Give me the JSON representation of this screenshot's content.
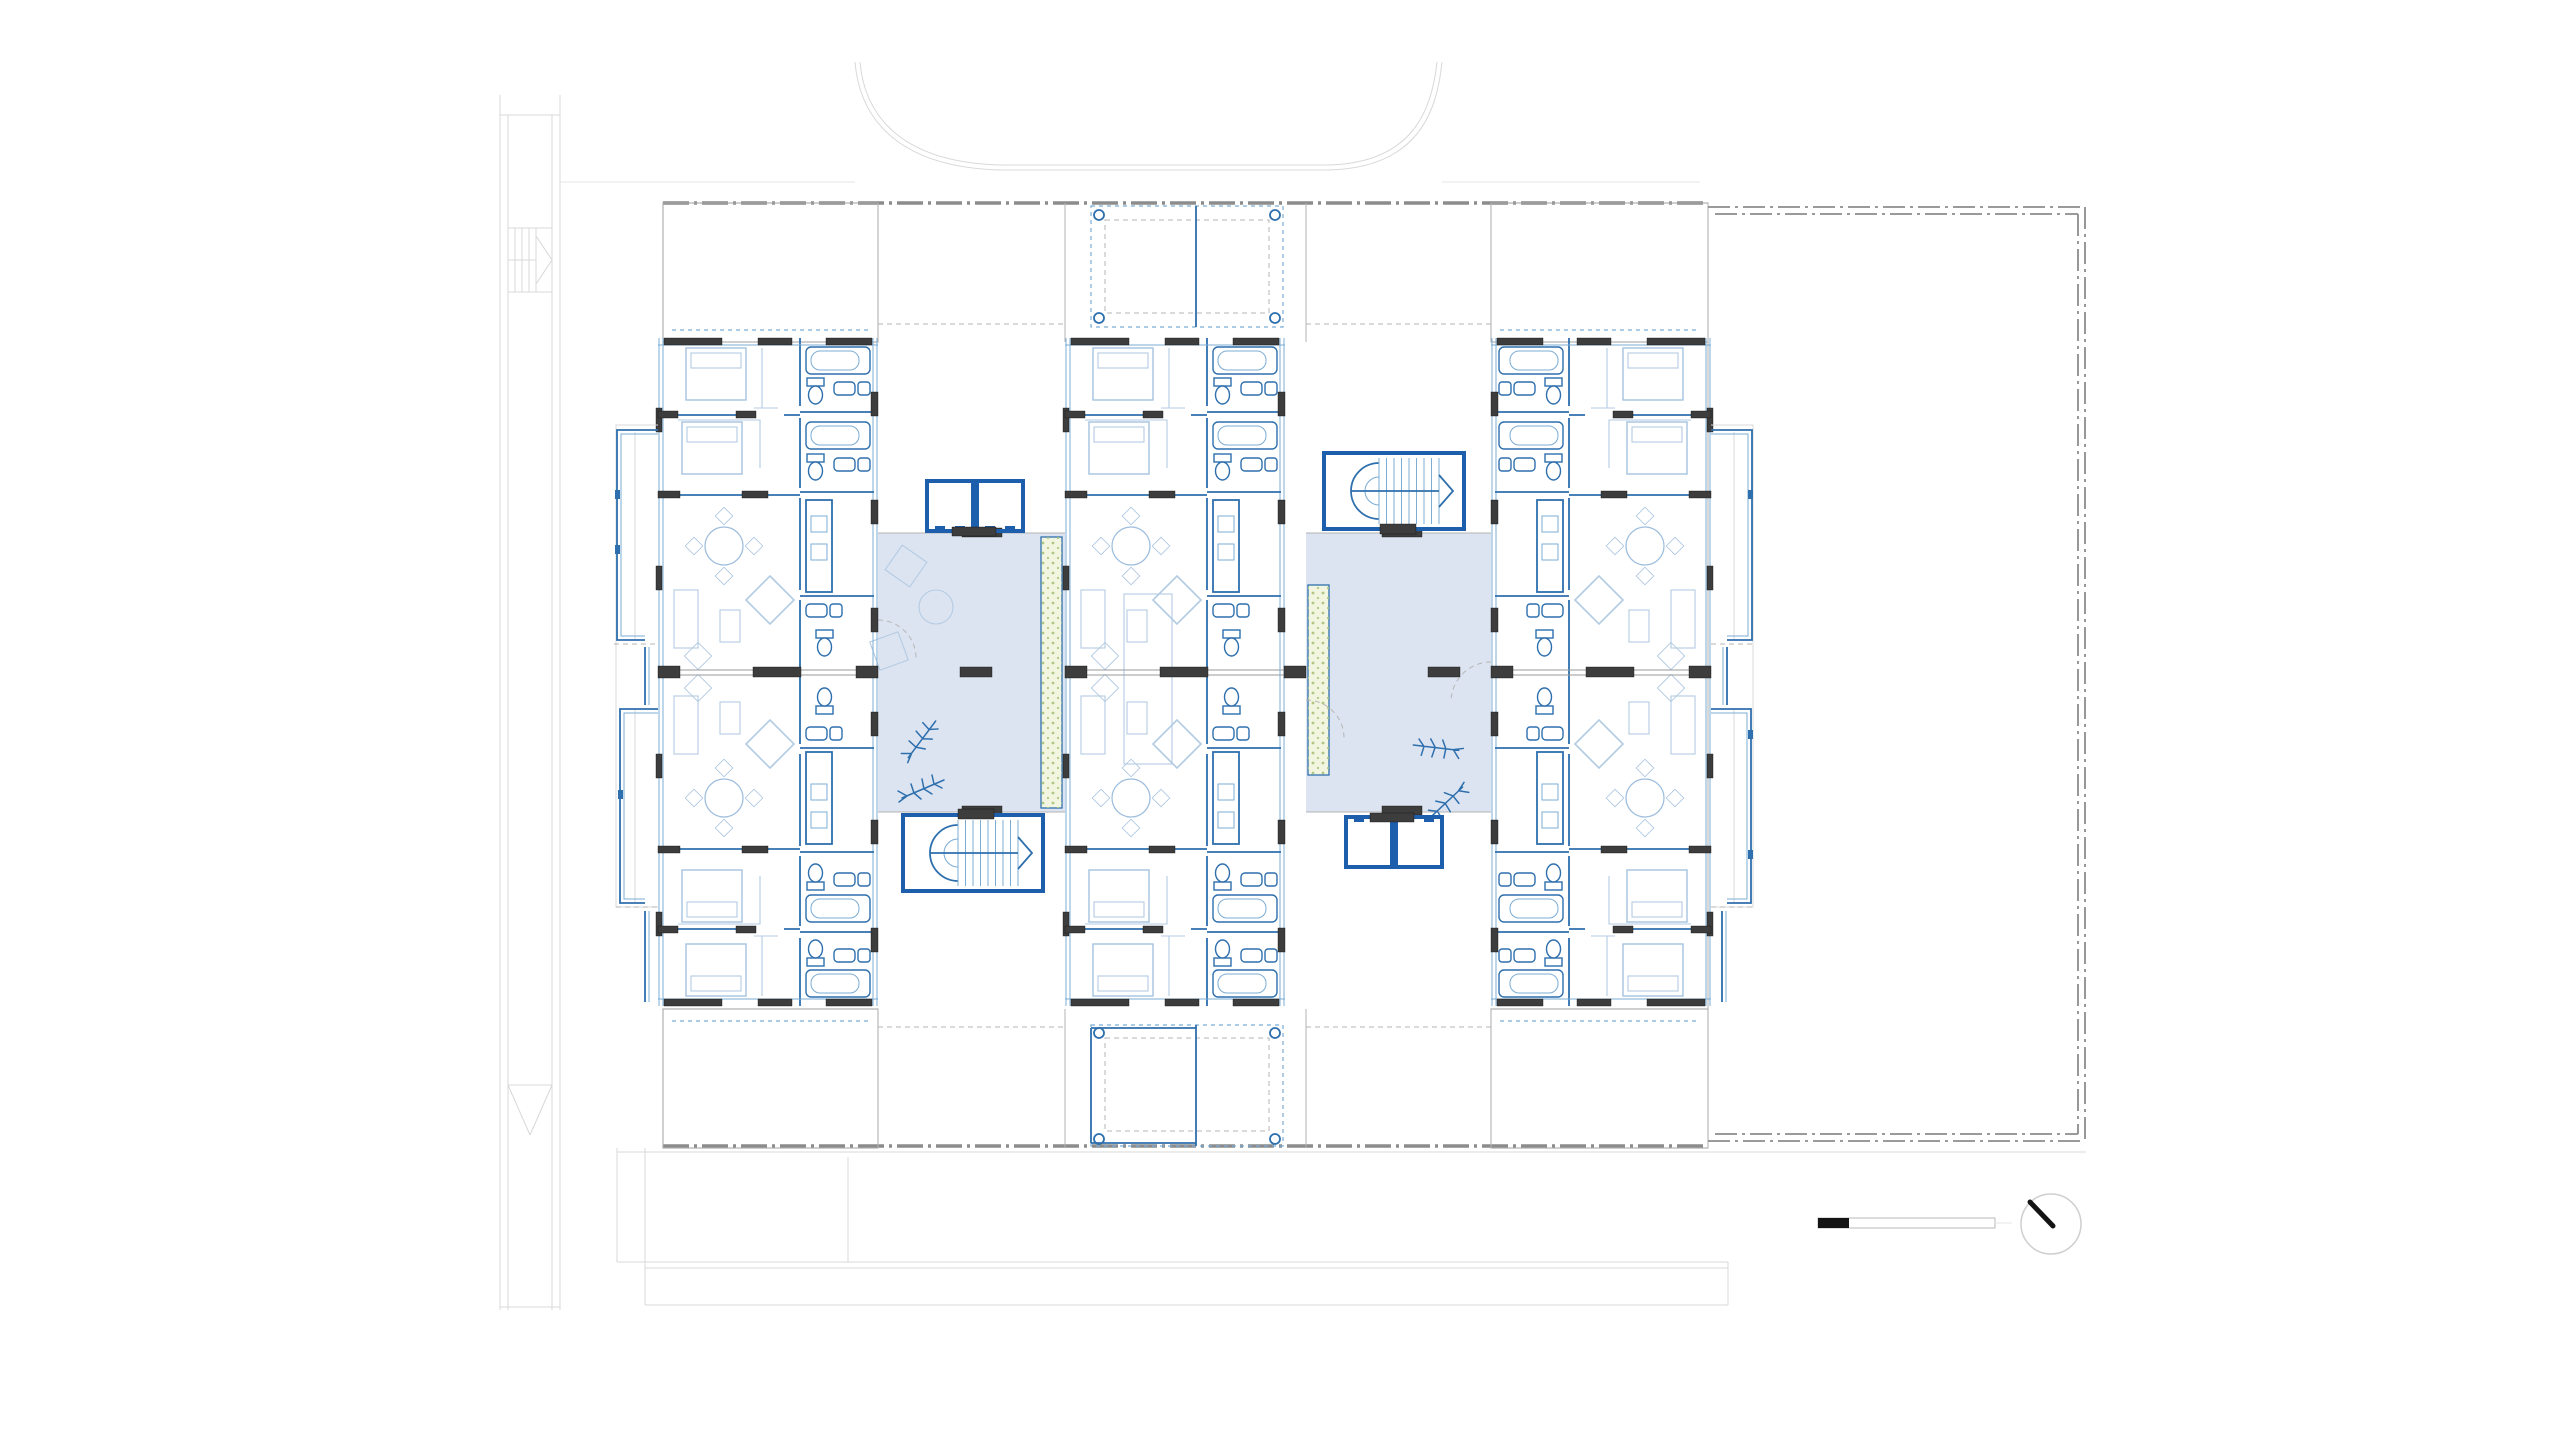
{
  "colors": {
    "paper": "#ffffff",
    "wall_blue": "#2e6fad",
    "deep_blue": "#1d5fad",
    "glazing_blue": "#7bacd4",
    "furniture_blue": "#9fbedd",
    "light_blue": "#b3cbe3",
    "wall_dark": "#3d3d3d",
    "outline_gray": "#8c8c8c",
    "context_gray": "#d8d8d8",
    "courtyard_fill": "#dde4f1",
    "planting_fill": "#f2f5e0",
    "planting_dot": "#aec781",
    "scale_black": "#141414"
  },
  "plan": {
    "type": "residential-floor-plan",
    "wings": [
      {
        "id": "west-wing",
        "apartments": 2,
        "features": [
          "bedrooms",
          "dining-table",
          "bathrooms",
          "kitchen",
          "stepped-balconies-west"
        ]
      },
      {
        "id": "center-wing",
        "apartments": 2,
        "features": [
          "bedrooms",
          "dining-table",
          "bathrooms",
          "kitchen",
          "north-balcony",
          "south-balcony"
        ]
      },
      {
        "id": "east-wing",
        "apartments": 2,
        "features": [
          "bedrooms",
          "dining-table",
          "bathrooms",
          "kitchen",
          "stepped-balconies-east"
        ]
      }
    ],
    "courtyards": [
      {
        "id": "west-courtyard",
        "features": [
          "elevator-pair-north",
          "open-stair-south",
          "planting-strip-east",
          "loose-furniture",
          "plant-symbols"
        ]
      },
      {
        "id": "east-courtyard",
        "features": [
          "open-stair-north",
          "elevator-pair-south",
          "planting-strip-west",
          "plant-symbols"
        ]
      }
    ],
    "balconies": [
      "north-balcony",
      "south-balcony"
    ],
    "terrace": {
      "id": "east-terrace",
      "border": "double-dash-dot"
    },
    "context": [
      "site-strip-west",
      "driveway-curve-north",
      "site-lines-south"
    ],
    "annotations": {
      "scale_bar": true,
      "north_arrow": true
    }
  }
}
